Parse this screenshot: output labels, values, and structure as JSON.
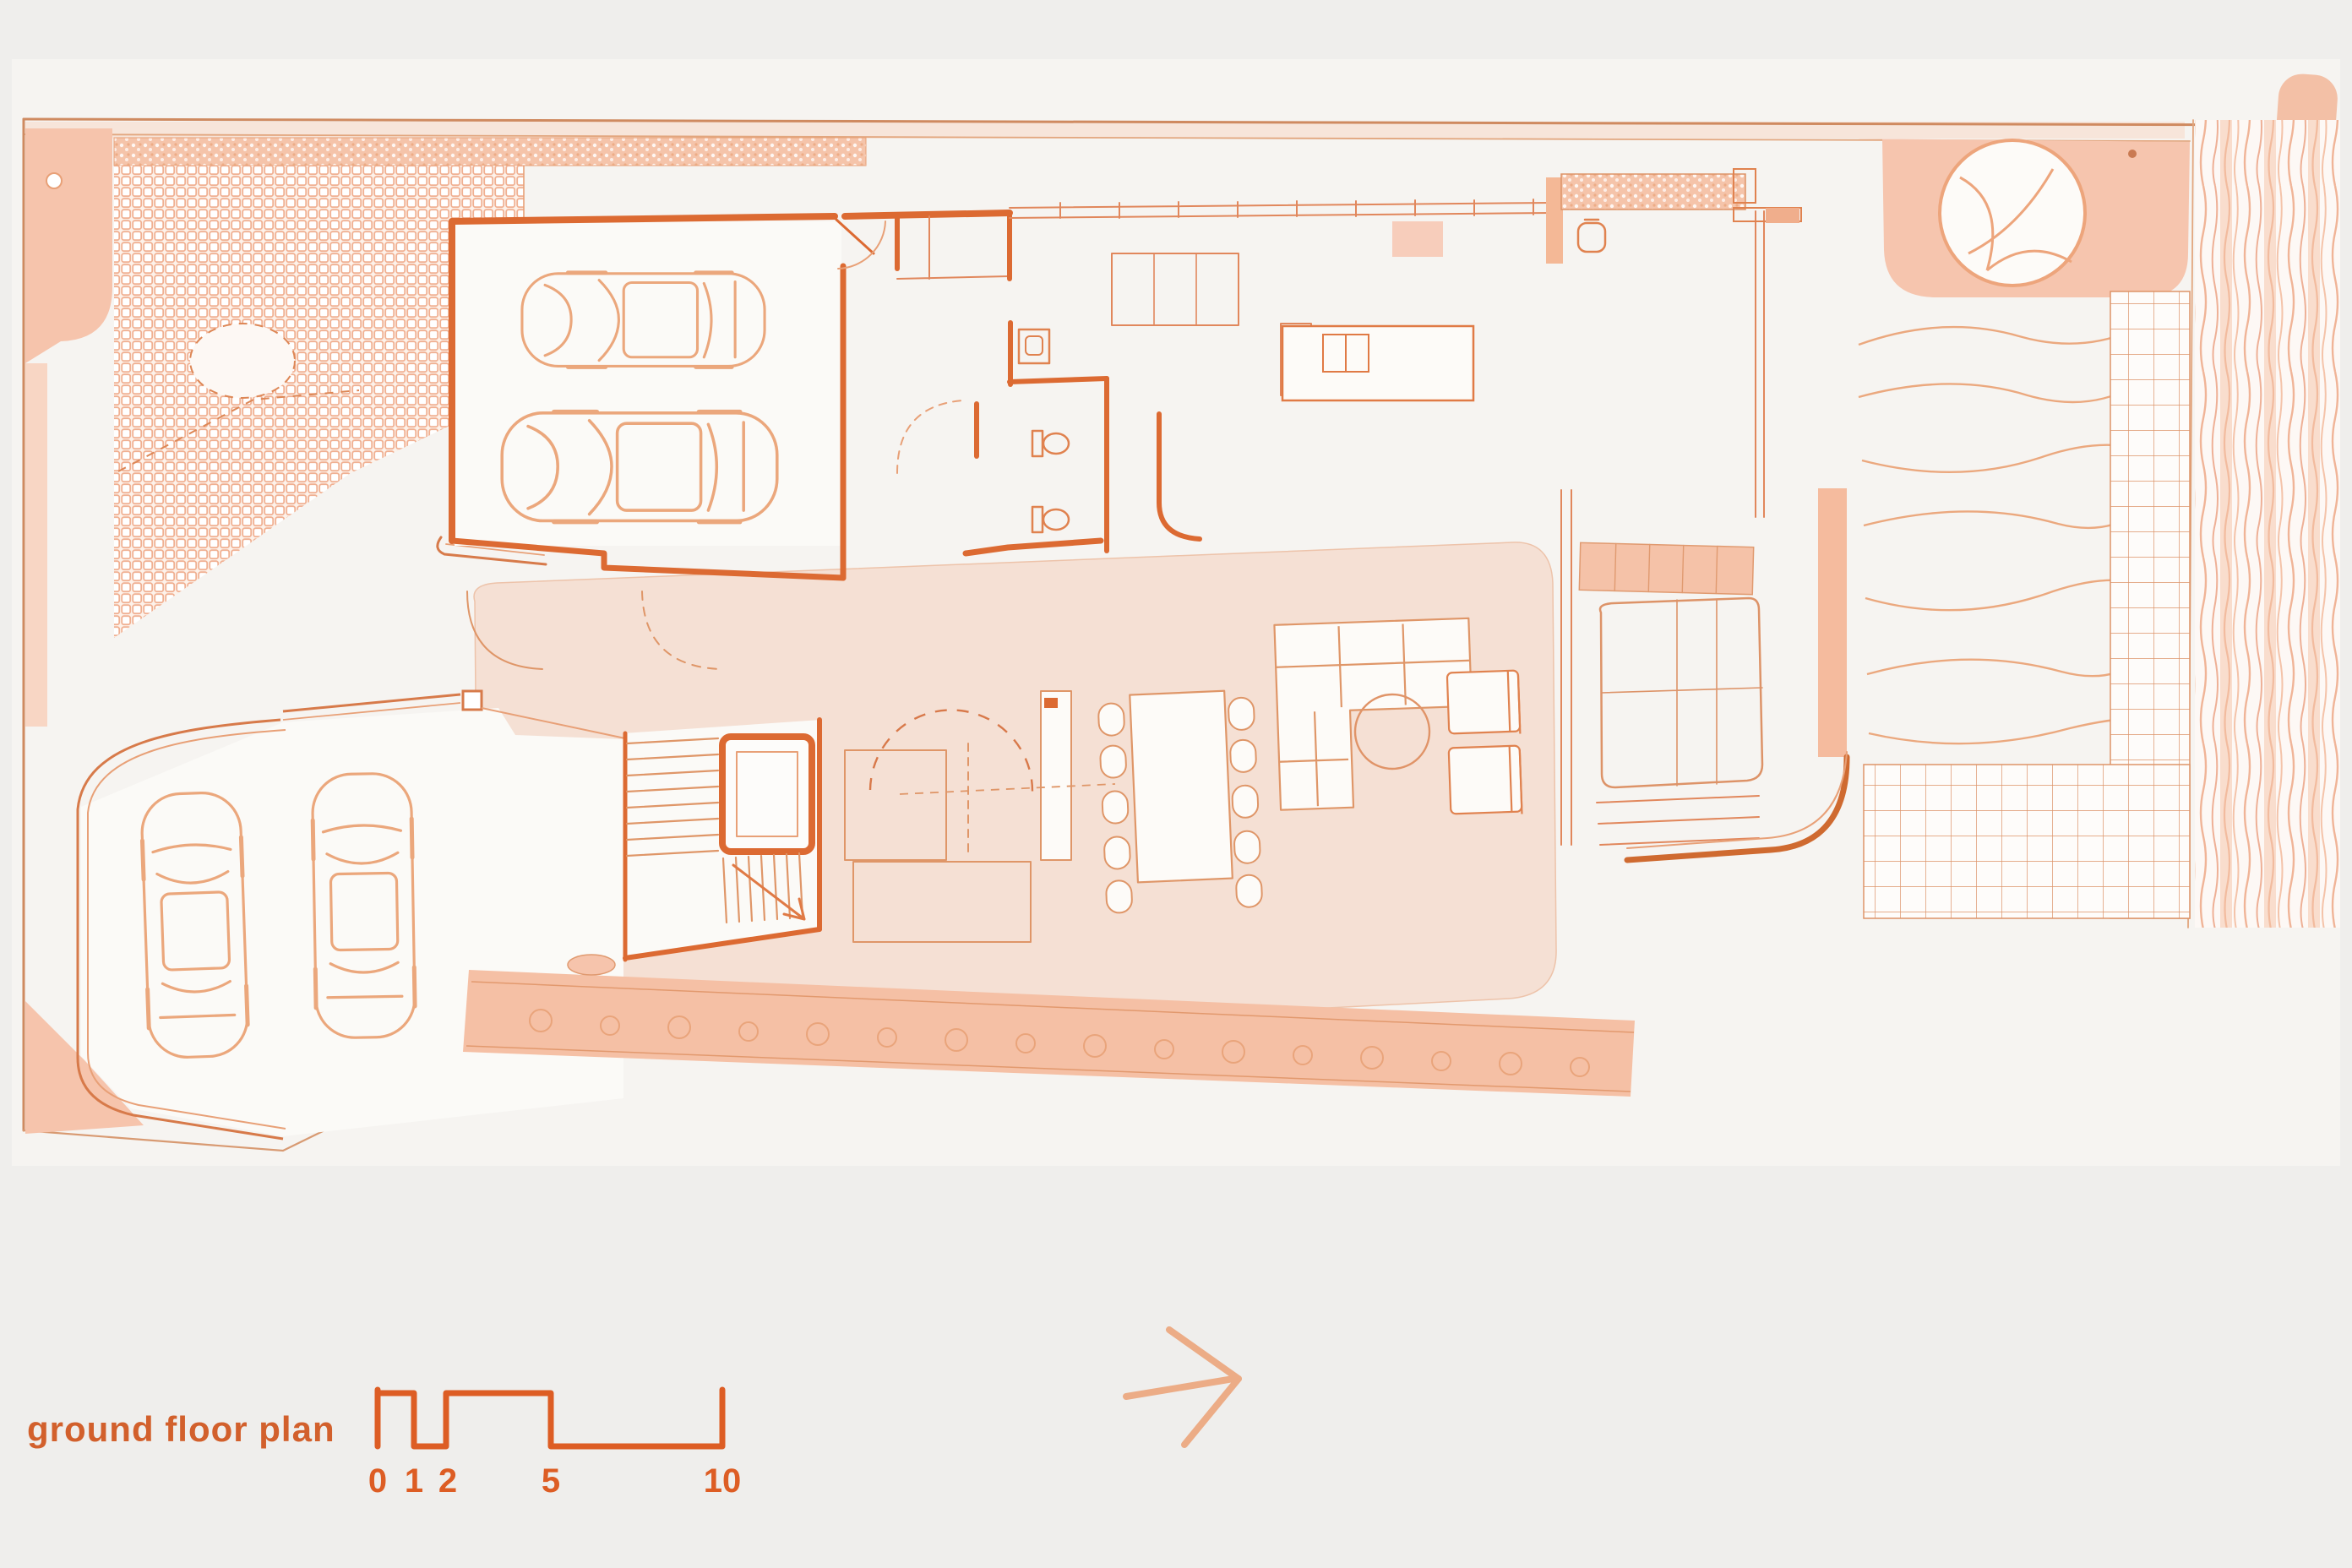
{
  "page": {
    "background_color": "#efeeec",
    "paper_color": "#fbf9f6"
  },
  "palette": {
    "wall_strong": "#dc6a32",
    "line_medium": "#e1875c",
    "line_light": "#edaa80",
    "line_faint": "#f2bfa2",
    "fill_salmon": "#f6c4ac",
    "fill_wash": "#f5dccd",
    "fill_deck": "#f5c0a5",
    "accent_text": "#d2602c",
    "scale_bar_color": "#dd5d24"
  },
  "title": {
    "label": "ground floor plan"
  },
  "scale_bar": {
    "labels": [
      "0",
      "1",
      "2",
      "5",
      "10"
    ]
  },
  "icons": {
    "north_arrow": "chevron-right-arrow",
    "tree": "tree-canopy-circle",
    "cars": "car-top-view"
  }
}
